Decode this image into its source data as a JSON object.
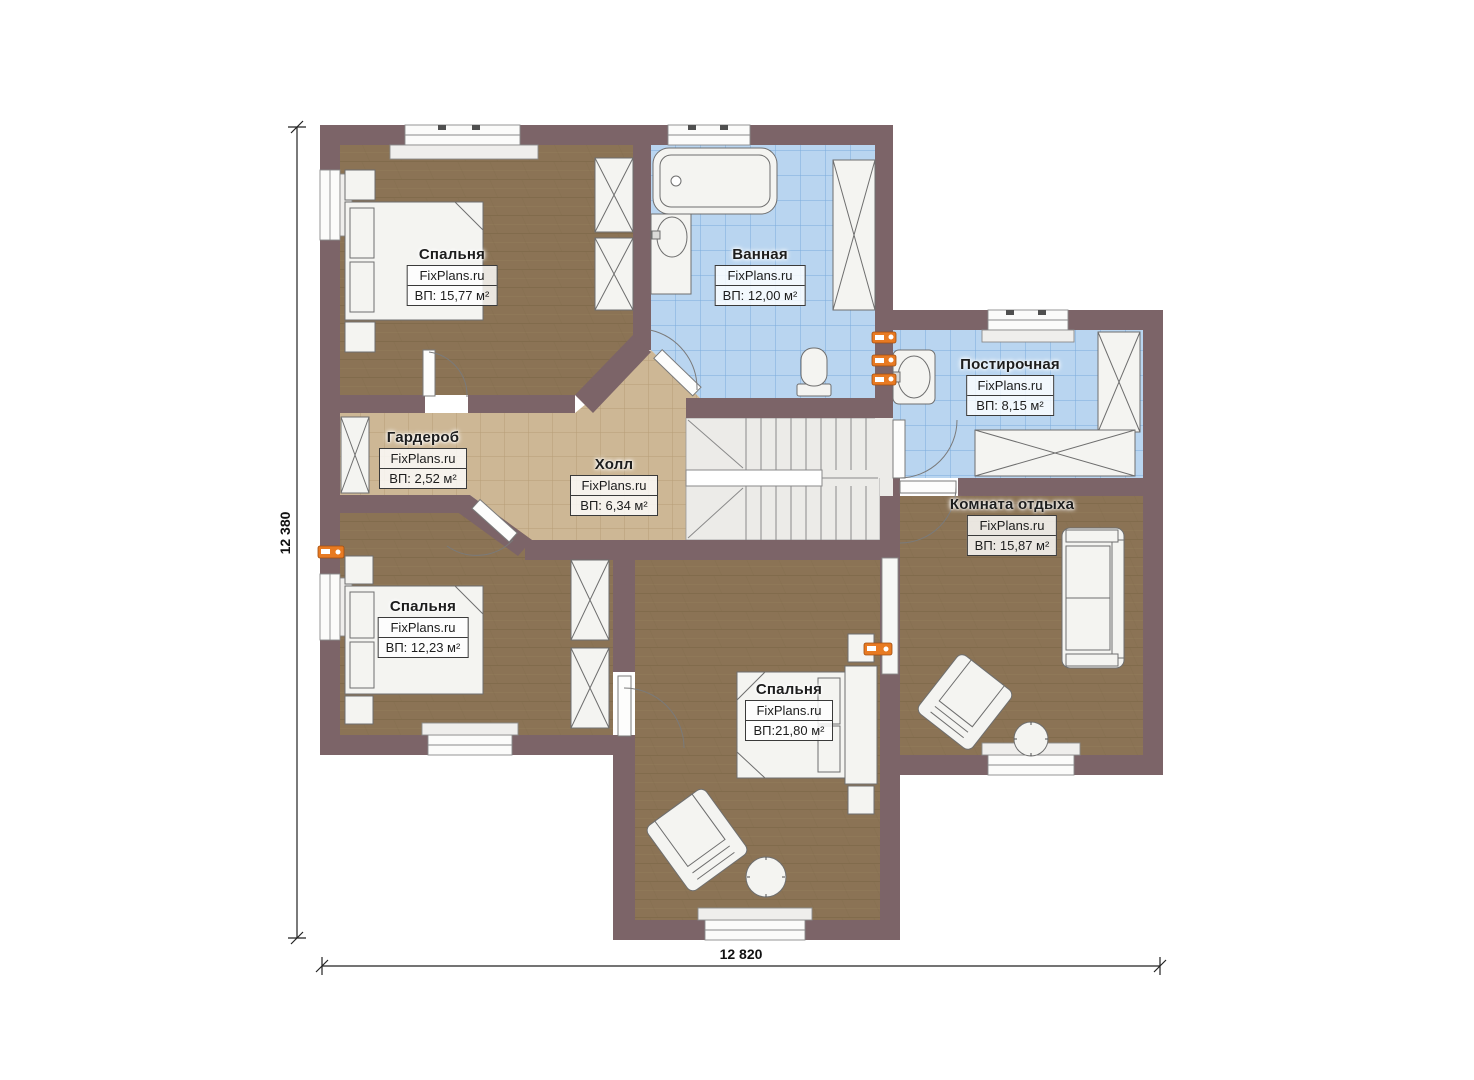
{
  "plan": {
    "brand": "FixPlans.ru",
    "rooms": [
      {
        "id": "bedroom-1",
        "name": "Спальня",
        "area": "ВП: 15,77 м²"
      },
      {
        "id": "bathroom",
        "name": "Ванная",
        "area": "ВП: 12,00 м²"
      },
      {
        "id": "laundry",
        "name": "Постирочная",
        "area": "ВП: 8,15 м²"
      },
      {
        "id": "wardrobe",
        "name": "Гардероб",
        "area": "ВП: 2,52 м²"
      },
      {
        "id": "hall",
        "name": "Холл",
        "area": "ВП: 6,34 м²"
      },
      {
        "id": "lounge",
        "name": "Комната отдыха",
        "area": "ВП: 15,87 м²"
      },
      {
        "id": "bedroom-2",
        "name": "Спальня",
        "area": "ВП: 12,23 м²"
      },
      {
        "id": "bedroom-3",
        "name": "Спальня",
        "area": "ВП:21,80 м²"
      }
    ],
    "dimensions": {
      "vertical": "12 380",
      "horizontal": "12 820"
    },
    "colors": {
      "wall": "#7c6468",
      "wood_floor": "#8b7355",
      "tile_tan": "#cdb795",
      "tile_blue": "#b9d5f0",
      "stairs": "#ecebe8",
      "radiator": "#e87a22",
      "furniture": "#f4f4f1"
    }
  }
}
